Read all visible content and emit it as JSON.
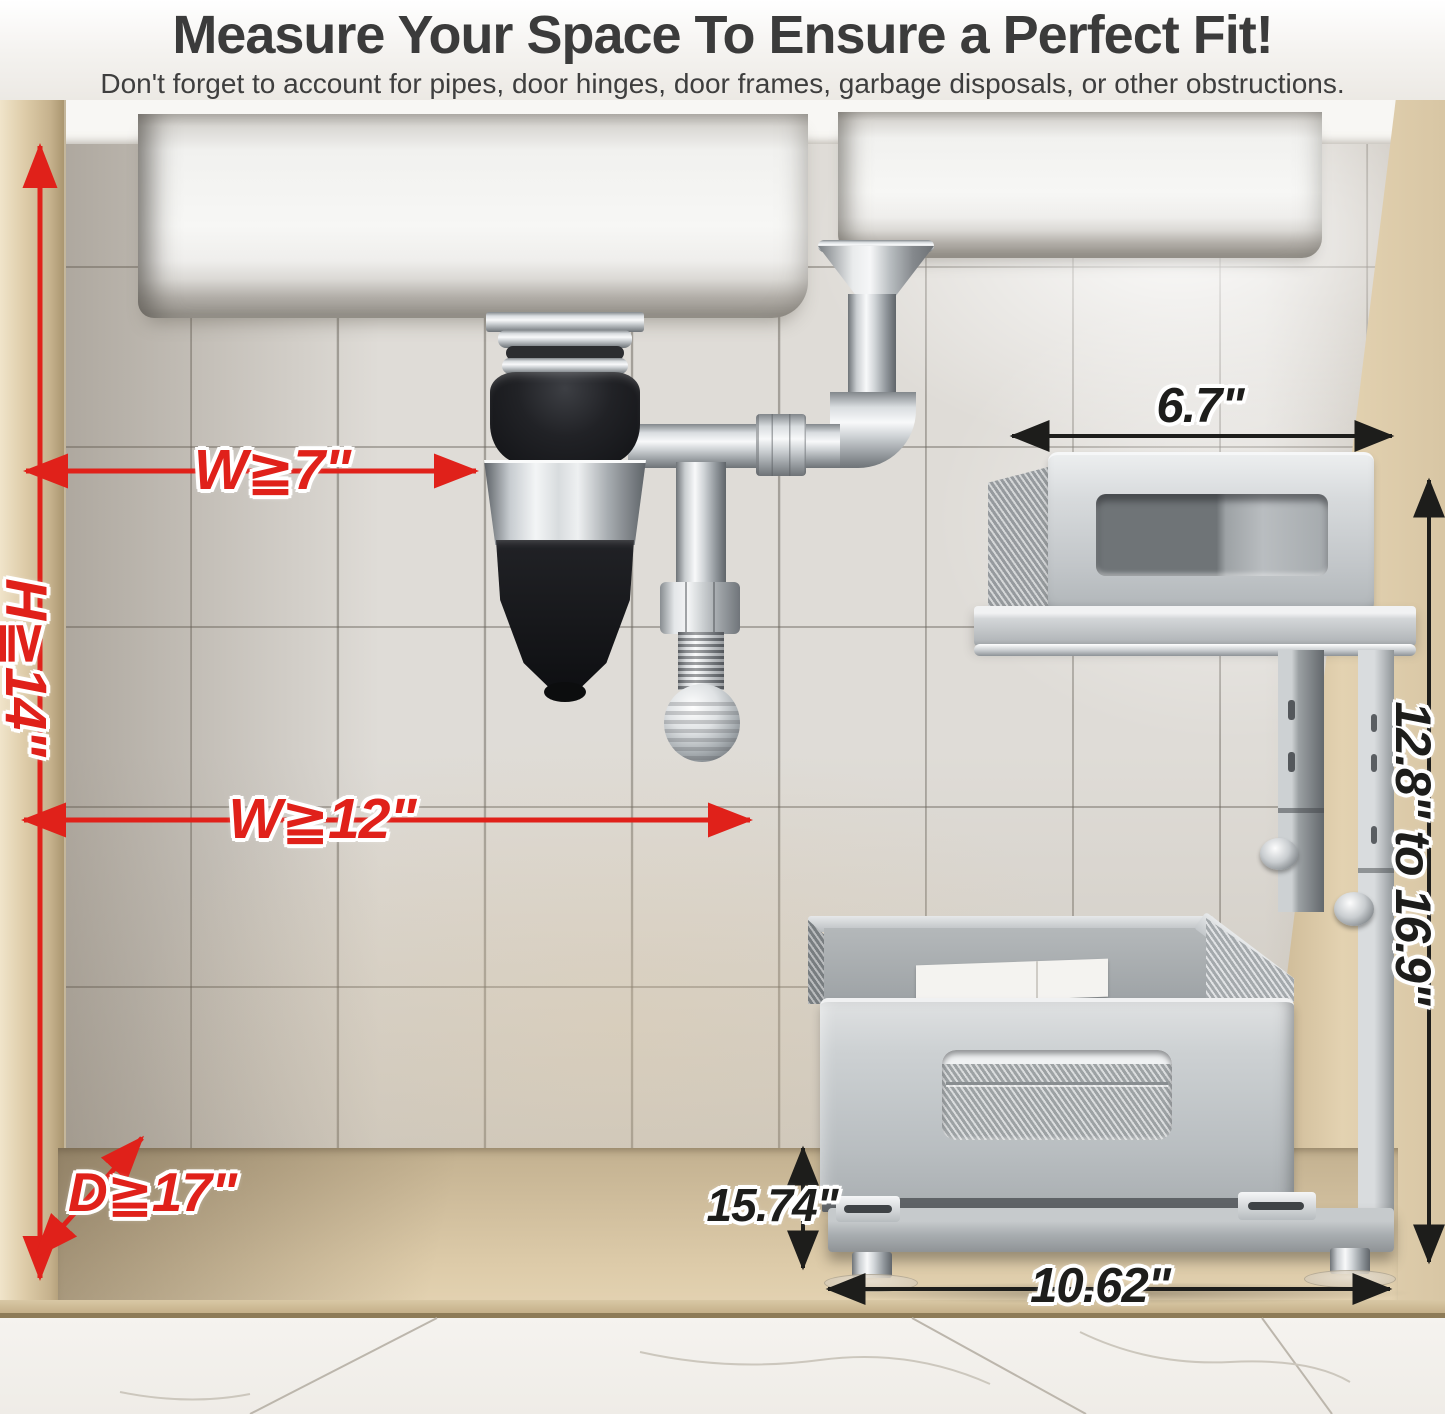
{
  "header": {
    "title": "Measure Your Space To Ensure a Perfect Fit!",
    "subtitle": "Don't forget to account for pipes, door hinges, door frames, garbage disposals, or other obstructions."
  },
  "measurements": {
    "cabinet": {
      "height_min": "H≧14\"",
      "width_min_disposal_side": "W≧7\"",
      "width_min_main": "W≧12\"",
      "depth_min": "D≧17\""
    },
    "organizer": {
      "top_shelf_width": "6.7\"",
      "adjustable_height": "12.8\" to 16.9\"",
      "drawer_depth": "15.74\"",
      "drawer_width": "10.62\""
    }
  },
  "colors": {
    "measurement_red": "#e0211a",
    "measurement_black": "#1d1d1b"
  }
}
